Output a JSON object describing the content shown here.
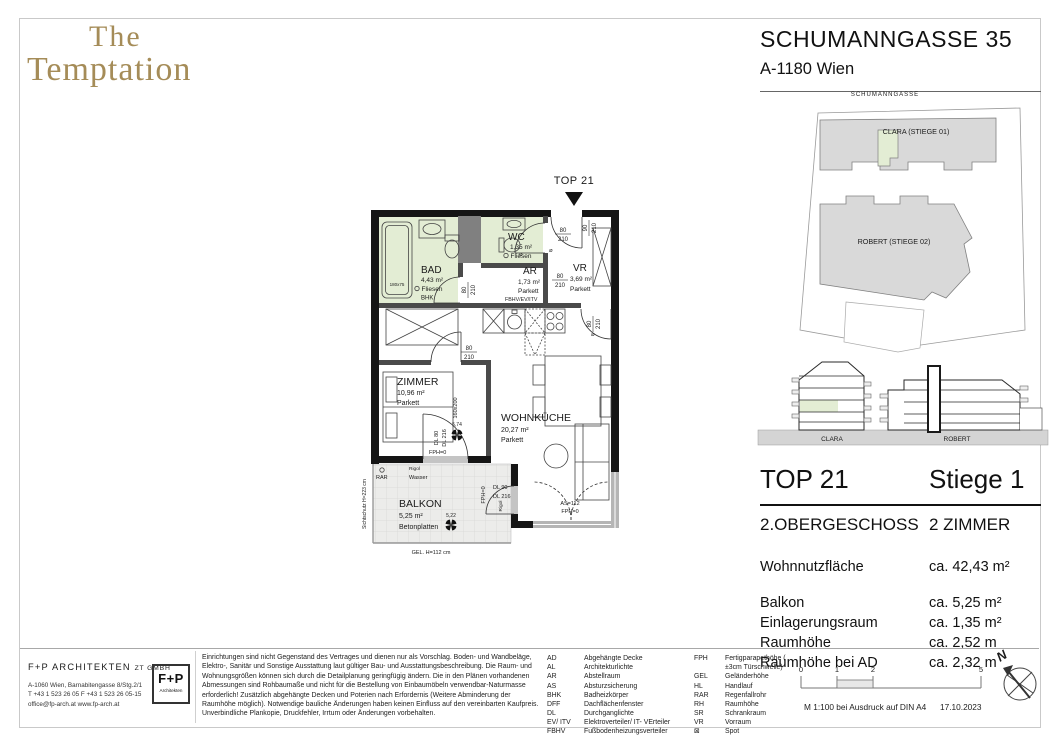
{
  "brand": {
    "line1": "The",
    "line2": "Temptation"
  },
  "header": {
    "title": "SCHUMANNGASSE 35",
    "subtitle": "A-1180 Wien"
  },
  "site_plan": {
    "street": "SCHUMANNGASSE",
    "clara": "CLARA (STIEGE 01)",
    "robert": "ROBERT (STIEGE 02)"
  },
  "elevation": {
    "clara": "CLARA",
    "robert": "ROBERT"
  },
  "unit": {
    "top": "TOP 21",
    "stiege": "Stiege 1",
    "floor": "2.OBERGESCHOSS",
    "rooms": "2 ZIMMER",
    "metrics": [
      {
        "label": "Wohnnutzfläche",
        "value": "ca. 42,43 m²"
      },
      {
        "label": "Balkon",
        "value": "ca. 5,25 m²"
      },
      {
        "label": "Einlagerungsraum",
        "value": "ca. 1,35 m²"
      },
      {
        "label": "Raumhöhe",
        "value": "ca. 2,52 m"
      },
      {
        "label": "Raumhöhe bei AD",
        "value": "ca. 2,32 m"
      }
    ]
  },
  "plan": {
    "unit_label": "TOP 21",
    "rooms": {
      "bad": {
        "name": "BAD",
        "area": "4,43 m²",
        "floor": "Fliesen",
        "note": "BHK"
      },
      "wc": {
        "name": "WC",
        "area": "1,35 m²",
        "floor": "Fliesen"
      },
      "ar": {
        "name": "AR",
        "area": "1,73 m²",
        "floor": "Parkett",
        "note": "FBHV/EV/ITV"
      },
      "vr": {
        "name": "VR",
        "area": "3,69 m²",
        "floor": "Parkett"
      },
      "zimmer": {
        "name": "ZIMMER",
        "area": "10,96 m²",
        "floor": "Parkett"
      },
      "wohnkueche": {
        "name": "WOHNKÜCHE",
        "area": "20,27 m²",
        "floor": "Parkett"
      },
      "balkon": {
        "name": "BALKON",
        "area": "5,25 m²",
        "floor": "Betonplatten"
      }
    },
    "dims": {
      "entrance": {
        "w": "90",
        "h": "210"
      },
      "wc_door": {
        "w": "80",
        "h": "210"
      },
      "ar_door": {
        "w": "80",
        "h": "210"
      },
      "bad_door": {
        "w": "80",
        "h": "210"
      },
      "zimmer_door": {
        "w": "80",
        "h": "210"
      },
      "living_door": {
        "w": "80",
        "h": "210"
      }
    },
    "ann": {
      "dl80": "DL 80",
      "dl216": "DL 216",
      "fph0": "FPH=0",
      "dl90": "DL 90",
      "dl216b": "DL 216",
      "fph0b": "FPH=0",
      "rigol2": "Rigol",
      "as112": "AS=112",
      "fph0c": "FPH=0",
      "spot1": "5,74",
      "spot2": "5,22",
      "rar": "RAR",
      "wasser": "Wasser",
      "rigol1": "Rigol",
      "gel": "GEL. H=112 cm",
      "sichtschutz": "Sichtschutz H=223 cm",
      "bed": "160x200",
      "tub": "180x75"
    }
  },
  "footer": {
    "architect": {
      "name": "F+P ARCHITEKTEN",
      "suffix": "ZT GMBH",
      "address": "A-1060 Wien, Barnabitengasse 8/Stg.2/1",
      "phone": "T +43 1 523 26 05   F +43 1 523 26 05-15",
      "web": "office@fp-arch.at    www.fp-arch.at",
      "logo_top": "F+P",
      "logo_sub": "Architekten"
    },
    "disclaimer": "Einrichtungen sind nicht Gegenstand des Vertrages und dienen nur als Vorschlag. Boden- und Wandbeläge, Elektro-, Sanitär und Sonstige Ausstattung laut gültiger Bau- und Ausstattungsbeschreibung. Die Raum- und Wohnungsgrößen können sich durch die Detailplanung geringfügig ändern. Die in den Plänen vorhandenen Abmessungen sind Rohbaumaße und nicht für die Bestellung von Einbaumöbeln  verwendbar-Naturmasse erforderlich! Zusätzlich abgehängte Decken und Poterien nach Erfordernis (Weitere Abminderung der Raumhöhe möglich). Notwendige bauliche Änderungen haben keinen Einfluss auf den vereinbarten Kaufpreis. Unverbindliche Plankopie, Druckfehler, Irrtum oder Änderungen vorbehalten.",
    "legend_col1": [
      {
        "abbr": "AD",
        "desc": "Abgehängte Decke"
      },
      {
        "abbr": "AL",
        "desc": "Architekturlichte"
      },
      {
        "abbr": "AR",
        "desc": "Abstellraum"
      },
      {
        "abbr": "AS",
        "desc": "Absturzsicherung"
      },
      {
        "abbr": "BHK",
        "desc": "Badheizkörper"
      },
      {
        "abbr": "DFF",
        "desc": "Dachflächenfenster"
      },
      {
        "abbr": "DL",
        "desc": "Durchganglichte"
      },
      {
        "abbr": "EV/ ITV",
        "desc": "Elektroverteiler/ IT- VErteiler"
      },
      {
        "abbr": "FBHV",
        "desc": "Fußbodenheizungsverteiler"
      }
    ],
    "legend_col2": [
      {
        "abbr": "FPH",
        "desc": "Fertigparapethöhe ( ±3cm Türschwelle)"
      },
      {
        "abbr": "GEL",
        "desc": "Geländerhöhe"
      },
      {
        "abbr": "HL",
        "desc": "Handlauf"
      },
      {
        "abbr": "RAR",
        "desc": "Regenfallrohr"
      },
      {
        "abbr": "RH",
        "desc": "Raumhöhe"
      },
      {
        "abbr": "SR",
        "desc": "Schrankraum"
      },
      {
        "abbr": "VR",
        "desc": "Vorraum"
      },
      {
        "abbr": "⊠",
        "desc": "Spot"
      }
    ],
    "scale": {
      "t0": "0",
      "t1": "1",
      "t2": "2",
      "t5": "5",
      "note": "M 1:100 bei Ausdruck auf DIN A4",
      "date": "17.10.2023"
    },
    "compass_n": "N"
  },
  "colors": {
    "accent_gold": "#A58C58",
    "room_green": "#E3EDD4",
    "building_gray": "#D9D9D9",
    "wall_black": "#151515"
  }
}
